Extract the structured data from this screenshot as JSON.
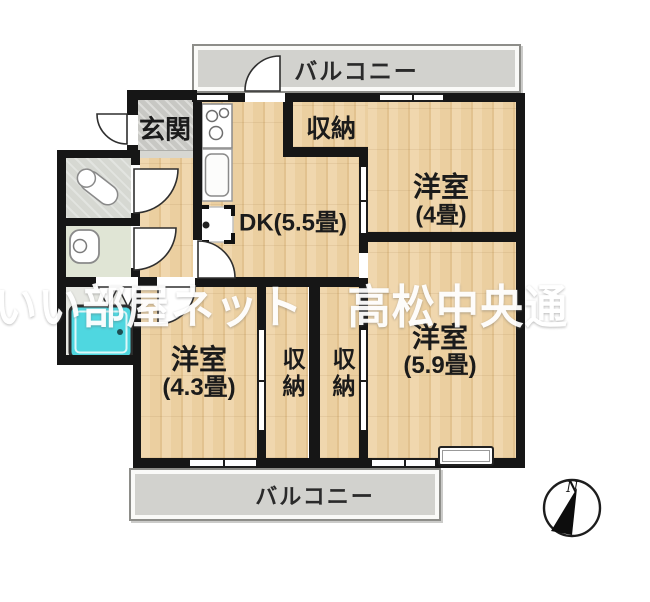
{
  "floorplan": {
    "watermark": "いい部屋ネット　高松中央通",
    "balcony_top": "バルコニー",
    "balcony_bottom": "バルコニー",
    "rooms": {
      "genkan": "玄関",
      "dk": "DK(5.5畳)",
      "closet_top": "収納",
      "bedroom_ne": {
        "name": "洋室",
        "size": "(4畳)"
      },
      "bedroom_se": {
        "name": "洋室",
        "size": "(5.9畳)"
      },
      "bedroom_sw": {
        "name": "洋室",
        "size": "(4.3畳)"
      },
      "closet_left": "収納",
      "closet_right": "収納"
    },
    "compass": {
      "north_label": "N"
    },
    "colors": {
      "wall": "#161616",
      "wood_floor": "#ecd0a2",
      "balcony": "#d2d2ce",
      "entrance_tile": "#c8c8c4",
      "toilet_floor": "#e0e5d5",
      "washroom_floor": "#d6d8d2",
      "bathtub": "#4fd7e0",
      "watermark_text": "#ffffff"
    }
  }
}
